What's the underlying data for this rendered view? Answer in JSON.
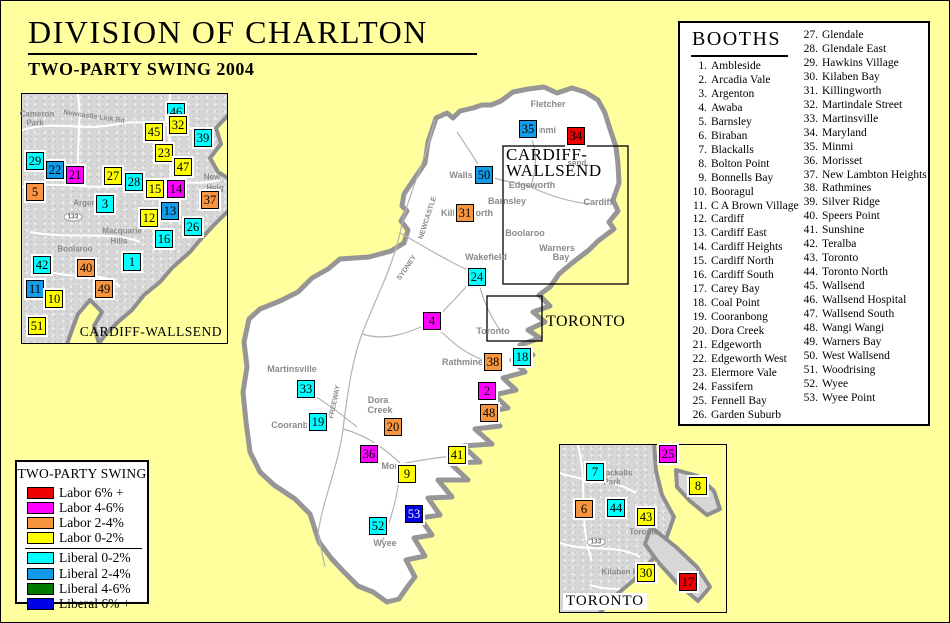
{
  "page": {
    "title": "DIVISION OF CHARLTON",
    "subtitle": "TWO-PARTY SWING 2004",
    "background": "#FFFF9E"
  },
  "colors": {
    "labor6": "#EE0000",
    "labor46": "#FF00FF",
    "labor24": "#F79540",
    "labor02": "#FFFF00",
    "lib02": "#00FFFF",
    "lib24": "#119BE8",
    "lib46": "#007B00",
    "lib6": "#0000E6"
  },
  "booths_panel": {
    "title": "BOOTHS",
    "items": [
      "Ambleside",
      "Arcadia Vale",
      "Argenton",
      "Awaba",
      "Barnsley",
      "Biraban",
      "Blackalls",
      "Bolton Point",
      "Bonnells Bay",
      "Booragul",
      "C A Brown Village",
      "Cardiff",
      "Cardiff East",
      "Cardiff Heights",
      "Cardiff North",
      "Cardiff South",
      "Carey Bay",
      "Coal Point",
      "Cooranbong",
      "Dora Creek",
      "Edgeworth",
      "Edgeworth West",
      "Elermore Vale",
      "Fassifern",
      "Fennell Bay",
      "Garden Suburb",
      "Glendale",
      "Glendale East",
      "Hawkins Village",
      "Kilaben Bay",
      "Killingworth",
      "Martindale Street",
      "Martinsville",
      "Maryland",
      "Minmi",
      "Morisset",
      "New Lambton Heights",
      "Rathmines",
      "Silver Ridge",
      "Speers Point",
      "Sunshine",
      "Teralba",
      "Toronto",
      "Toronto North",
      "Wallsend",
      "Wallsend Hospital",
      "Wallsend South",
      "Wangi Wangi",
      "Warners Bay",
      "West Wallsend",
      "Woodrising",
      "Wyee",
      "Wyee Point"
    ]
  },
  "legend": {
    "title": "TWO-PARTY SWING",
    "entries": [
      {
        "label": "Labor 6% +",
        "color": "#EE0000"
      },
      {
        "label": "Labor 4-6%",
        "color": "#FF00FF"
      },
      {
        "label": "Labor 2-4%",
        "color": "#F79540"
      },
      {
        "label": "Labor 0-2%",
        "color": "#FFFF00"
      },
      {
        "label": "Liberal 0-2%",
        "color": "#00FFFF"
      },
      {
        "label": "Liberal 2-4%",
        "color": "#119BE8"
      },
      {
        "label": "Liberal 4-6%",
        "color": "#007B00"
      },
      {
        "label": "Liberal 6% +",
        "color": "#0000E6"
      }
    ],
    "divider_after": 4
  },
  "main_map": {
    "cw_indicator_line1": "CARDIFF-",
    "cw_indicator_line2": "WALLSEND",
    "toronto_indicator_label": "TORONTO"
  },
  "cw_inset": {
    "label": "CARDIFF-WALLSEND"
  },
  "toronto_inset": {
    "label": "TORONTO"
  },
  "map_labels": [
    {
      "t": "Fletcher",
      "x": 547,
      "y": 103
    },
    {
      "t": "Minmi",
      "x": 542,
      "y": 129
    },
    {
      "t": "send.",
      "x": 577,
      "y": 162,
      "s": 8
    },
    {
      "t": "Wallsend",
      "x": 468,
      "y": 174
    },
    {
      "t": "Edgeworth",
      "x": 531,
      "y": 184
    },
    {
      "t": "Barnsley",
      "x": 506,
      "y": 200
    },
    {
      "t": "Cardiff",
      "x": 597,
      "y": 201
    },
    {
      "t": "Killingworth",
      "x": 466,
      "y": 212
    },
    {
      "t": "Boolaroo",
      "x": 524,
      "y": 232
    },
    {
      "t": "Warners",
      "x": 556,
      "y": 247
    },
    {
      "t": "Bay",
      "x": 560,
      "y": 256
    },
    {
      "t": "Wakefield",
      "x": 485,
      "y": 256
    },
    {
      "t": "Toronto",
      "x": 492,
      "y": 330
    },
    {
      "t": "Rathmines",
      "x": 464,
      "y": 361
    },
    {
      "t": "Martinsville",
      "x": 291,
      "y": 368
    },
    {
      "t": "Dora",
      "x": 377,
      "y": 399
    },
    {
      "t": "Creek",
      "x": 379,
      "y": 409
    },
    {
      "t": "Cooranbong",
      "x": 297,
      "y": 424
    },
    {
      "t": "Morisset",
      "x": 399,
      "y": 465
    },
    {
      "t": "Wyee",
      "x": 384,
      "y": 542
    },
    {
      "t": "NEWCASTLE",
      "x": 427,
      "y": 217,
      "r": -72,
      "s": 7
    },
    {
      "t": "SYDNEY",
      "x": 406,
      "y": 267,
      "r": -55,
      "s": 7
    },
    {
      "t": "FREEWAY",
      "x": 334,
      "y": 401,
      "r": -78,
      "s": 7
    },
    {
      "t": "Cameron",
      "x": 36,
      "y": 113,
      "s": 8
    },
    {
      "t": "Park",
      "x": 34,
      "y": 122,
      "s": 8
    },
    {
      "t": "Newcastle Link Rd",
      "x": 93,
      "y": 116,
      "r": 8,
      "s": 7
    },
    {
      "t": "New",
      "x": 211,
      "y": 176,
      "s": 8
    },
    {
      "t": "Heig",
      "x": 214,
      "y": 187,
      "s": 8
    },
    {
      "t": "Argenton",
      "x": 90,
      "y": 202,
      "s": 8
    },
    {
      "t": "Macquarie",
      "x": 121,
      "y": 230,
      "s": 8
    },
    {
      "t": "Hills",
      "x": 118,
      "y": 240,
      "s": 8
    },
    {
      "t": "Boolaroo",
      "x": 74,
      "y": 248,
      "s": 8
    },
    {
      "t": "133",
      "x": 72,
      "y": 216,
      "shield": true
    },
    {
      "t": "Blackalls",
      "x": 614,
      "y": 472,
      "s": 8
    },
    {
      "t": "Park",
      "x": 611,
      "y": 481,
      "s": 8
    },
    {
      "t": "Toronto",
      "x": 643,
      "y": 531,
      "s": 8
    },
    {
      "t": "Kilaben B",
      "x": 619,
      "y": 571,
      "s": 8
    },
    {
      "t": "133",
      "x": 595,
      "y": 541,
      "shield": true
    }
  ],
  "squares": [
    {
      "n": 35,
      "x": 527,
      "y": 128,
      "c": "lib24"
    },
    {
      "n": 34,
      "x": 575,
      "y": 135,
      "c": "labor6"
    },
    {
      "n": 50,
      "x": 483,
      "y": 174,
      "c": "lib24"
    },
    {
      "n": 31,
      "x": 464,
      "y": 212,
      "c": "labor24"
    },
    {
      "n": 24,
      "x": 476,
      "y": 276,
      "c": "lib02"
    },
    {
      "n": 4,
      "x": 431,
      "y": 320,
      "c": "labor46"
    },
    {
      "n": 18,
      "x": 521,
      "y": 356,
      "c": "lib02"
    },
    {
      "n": 38,
      "x": 492,
      "y": 361,
      "c": "labor24"
    },
    {
      "n": 2,
      "x": 486,
      "y": 390,
      "c": "labor46"
    },
    {
      "n": 48,
      "x": 488,
      "y": 412,
      "c": "labor24"
    },
    {
      "n": 33,
      "x": 305,
      "y": 388,
      "c": "lib02"
    },
    {
      "n": 19,
      "x": 317,
      "y": 421,
      "c": "lib02"
    },
    {
      "n": 20,
      "x": 392,
      "y": 426,
      "c": "labor24"
    },
    {
      "n": 36,
      "x": 368,
      "y": 453,
      "c": "labor46"
    },
    {
      "n": 41,
      "x": 456,
      "y": 454,
      "c": "labor02"
    },
    {
      "n": 9,
      "x": 406,
      "y": 473,
      "c": "labor02"
    },
    {
      "n": 53,
      "x": 413,
      "y": 513,
      "c": "lib6",
      "w": 1
    },
    {
      "n": 52,
      "x": 377,
      "y": 525,
      "c": "lib02"
    },
    {
      "n": 46,
      "x": 175,
      "y": 111,
      "c": "lib02"
    },
    {
      "n": 32,
      "x": 177,
      "y": 124,
      "c": "labor02"
    },
    {
      "n": 45,
      "x": 153,
      "y": 131,
      "c": "labor02"
    },
    {
      "n": 39,
      "x": 202,
      "y": 137,
      "c": "lib02"
    },
    {
      "n": 23,
      "x": 163,
      "y": 152,
      "c": "labor02"
    },
    {
      "n": 29,
      "x": 34,
      "y": 160,
      "c": "lib02"
    },
    {
      "n": 47,
      "x": 182,
      "y": 166,
      "c": "labor02"
    },
    {
      "n": 22,
      "x": 54,
      "y": 169,
      "c": "lib24"
    },
    {
      "n": 21,
      "x": 74,
      "y": 174,
      "c": "labor46"
    },
    {
      "n": 27,
      "x": 112,
      "y": 175,
      "c": "labor02"
    },
    {
      "n": 28,
      "x": 133,
      "y": 181,
      "c": "lib02"
    },
    {
      "n": 5,
      "x": 34,
      "y": 191,
      "c": "labor24"
    },
    {
      "n": 15,
      "x": 154,
      "y": 188,
      "c": "labor02"
    },
    {
      "n": 14,
      "x": 175,
      "y": 188,
      "c": "labor46"
    },
    {
      "n": 37,
      "x": 209,
      "y": 199,
      "c": "labor24"
    },
    {
      "n": 3,
      "x": 104,
      "y": 203,
      "c": "lib02"
    },
    {
      "n": 13,
      "x": 169,
      "y": 210,
      "c": "lib24"
    },
    {
      "n": 12,
      "x": 148,
      "y": 217,
      "c": "labor02"
    },
    {
      "n": 26,
      "x": 192,
      "y": 226,
      "c": "lib02"
    },
    {
      "n": 16,
      "x": 163,
      "y": 238,
      "c": "lib02"
    },
    {
      "n": 42,
      "x": 41,
      "y": 264,
      "c": "lib02"
    },
    {
      "n": 1,
      "x": 131,
      "y": 261,
      "c": "lib02"
    },
    {
      "n": 40,
      "x": 85,
      "y": 267,
      "c": "labor24"
    },
    {
      "n": 11,
      "x": 34,
      "y": 288,
      "c": "lib24"
    },
    {
      "n": 49,
      "x": 103,
      "y": 288,
      "c": "labor24"
    },
    {
      "n": 10,
      "x": 53,
      "y": 298,
      "c": "labor02"
    },
    {
      "n": 51,
      "x": 36,
      "y": 325,
      "c": "labor02"
    },
    {
      "n": 25,
      "x": 667,
      "y": 453,
      "c": "labor46"
    },
    {
      "n": 7,
      "x": 594,
      "y": 471,
      "c": "lib02"
    },
    {
      "n": 8,
      "x": 697,
      "y": 485,
      "c": "labor02"
    },
    {
      "n": 6,
      "x": 583,
      "y": 508,
      "c": "labor24"
    },
    {
      "n": 44,
      "x": 615,
      "y": 507,
      "c": "lib02"
    },
    {
      "n": 43,
      "x": 645,
      "y": 516,
      "c": "labor02"
    },
    {
      "n": 30,
      "x": 645,
      "y": 572,
      "c": "labor02"
    },
    {
      "n": 17,
      "x": 687,
      "y": 581,
      "c": "labor6"
    }
  ]
}
